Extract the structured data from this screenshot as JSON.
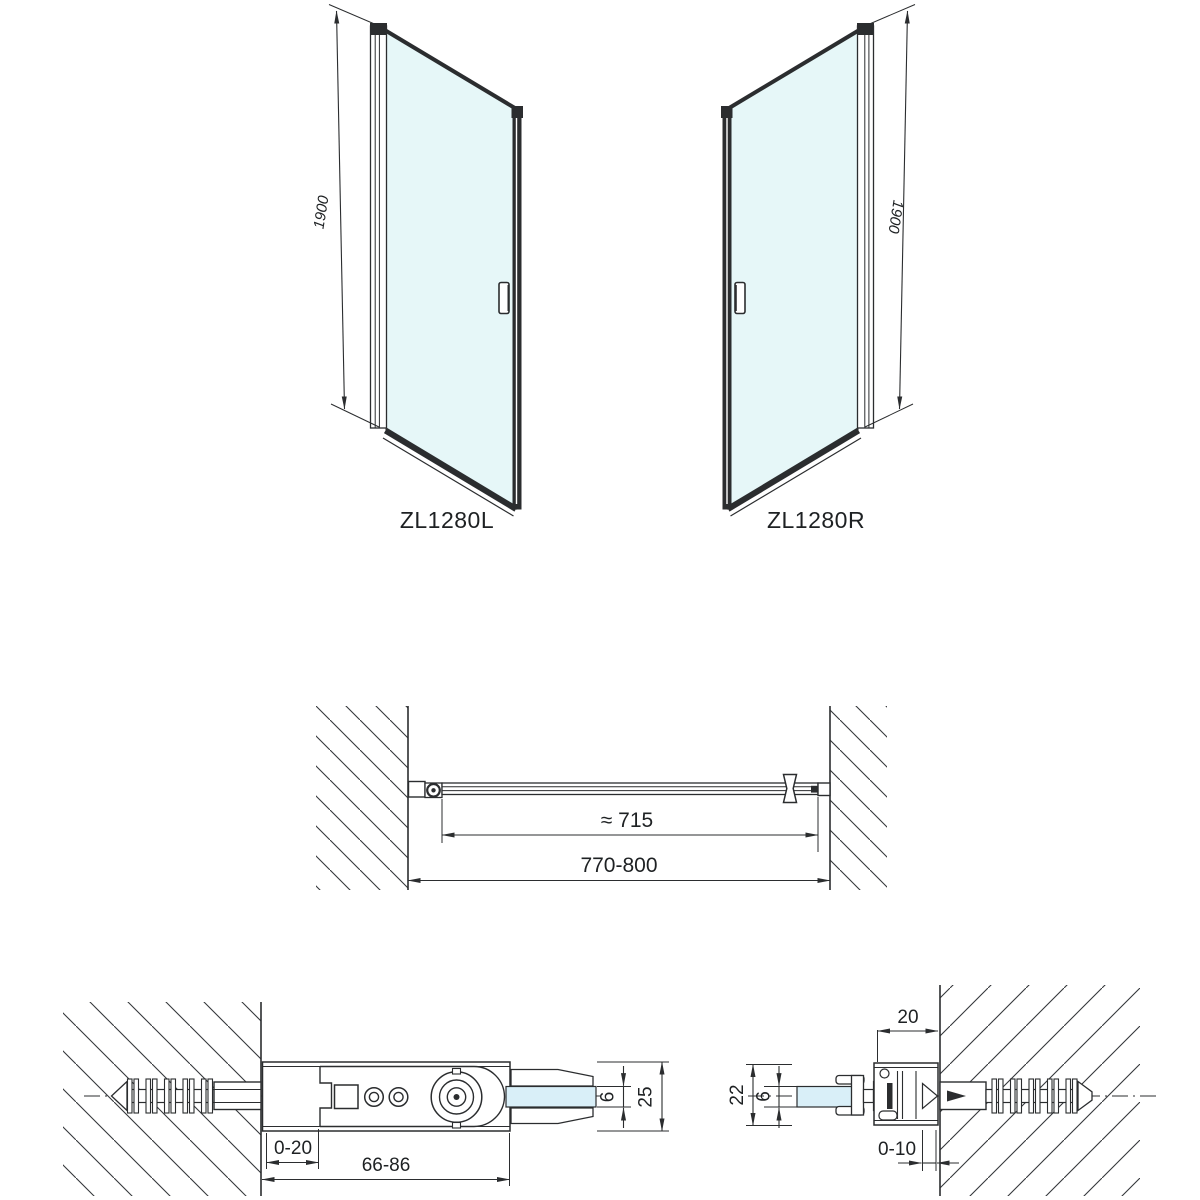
{
  "document": {
    "type": "technical_drawing",
    "product_models": [
      "ZL1280L",
      "ZL1280R"
    ]
  },
  "views": {
    "front_left_door": {
      "label": "ZL1280L",
      "height_dim": "1900"
    },
    "front_right_door": {
      "label": "ZL1280R",
      "height_dim": "1900"
    },
    "plan_view": {
      "glass_width_dim": "≈ 715",
      "installation_width_dim": "770-800"
    },
    "hinge_bracket_detail": {
      "wall_gap_dim": "0-20",
      "bracket_length_dim": "66-86",
      "glass_thickness_dim": "6",
      "profile_depth_dim": "25"
    },
    "wall_profile_detail": {
      "profile_width_dim": "20",
      "profile_depth_dim": "22",
      "glass_thickness_dim": "6",
      "adjustment_dim": "0-10"
    }
  },
  "colors": {
    "line": "#2b2d2f",
    "glass_front": "#e6f7f8",
    "glass_section": "#d9eff8",
    "hatch": "#34373a",
    "background": "#ffffff"
  }
}
